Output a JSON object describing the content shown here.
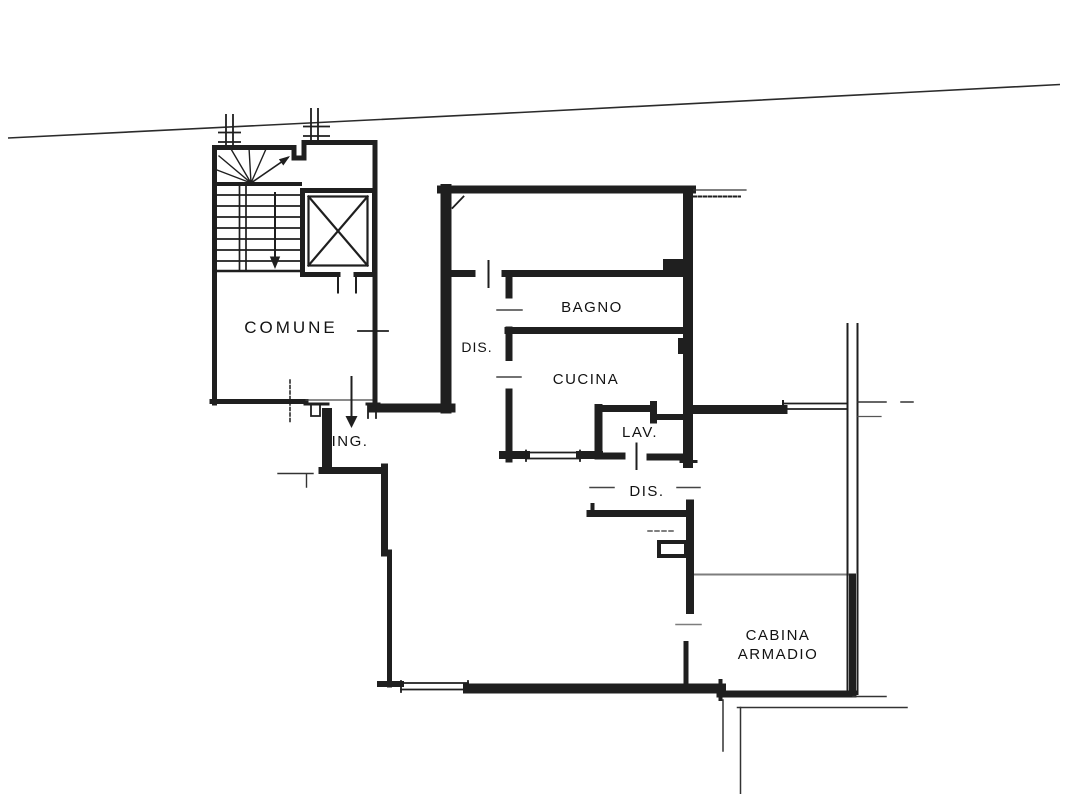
{
  "plan": {
    "type": "apartment-floor-plan",
    "rooms": {
      "comune": "COMUNE",
      "dis1": "DIS.",
      "bagno": "BAGNO",
      "cucina": "CUCINA",
      "lav": "LAV.",
      "dis2": "DIS.",
      "ing": "ING.",
      "cabina_line1": "CABINA",
      "cabina_line2": "ARMADIO"
    },
    "colors": {
      "wall": "#1f1f1f",
      "thin_line": "#333333",
      "divider_gray": "#7d7d7d",
      "background": "#ffffff"
    }
  }
}
